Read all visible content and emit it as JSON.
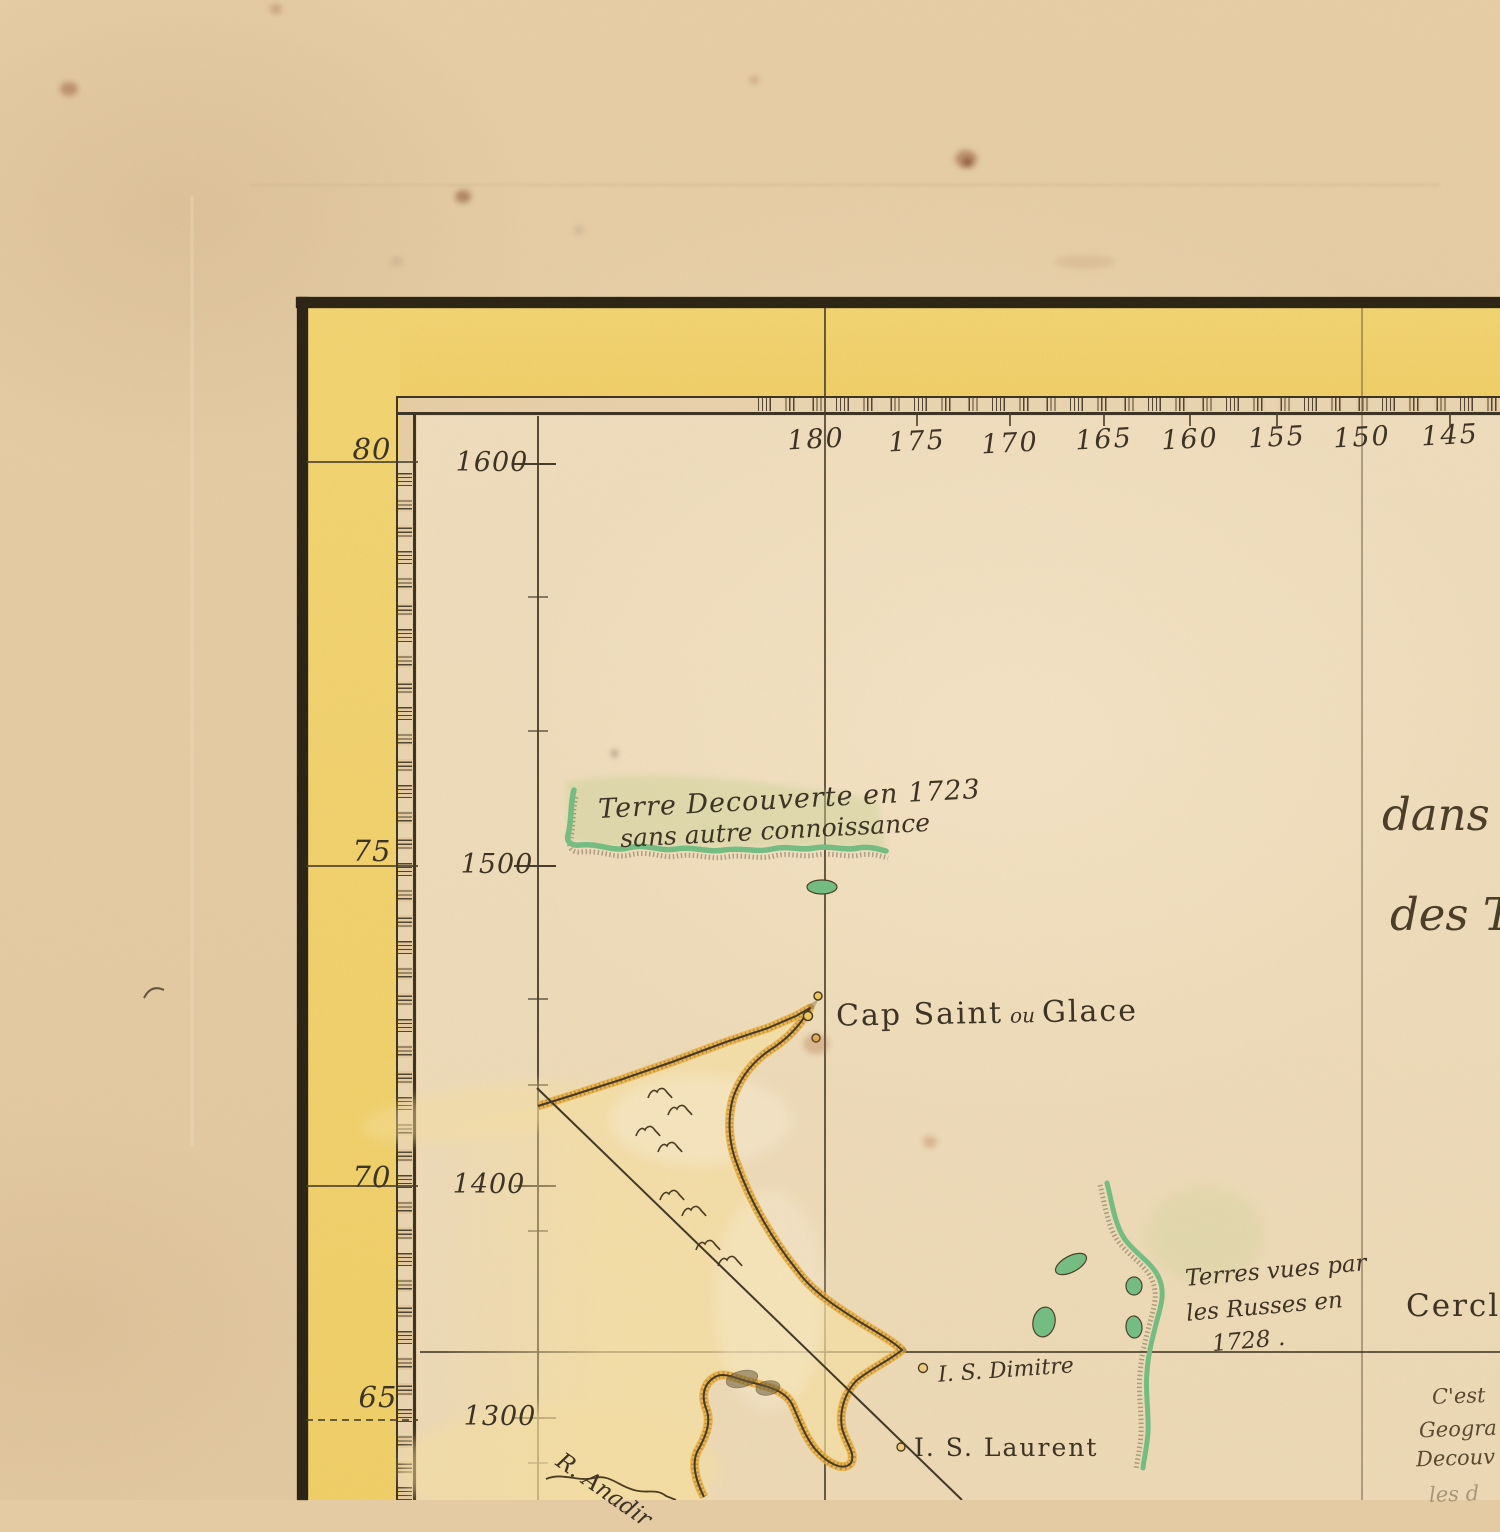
{
  "frame": {
    "longitude_labels": [
      "180",
      "175",
      "170",
      "165",
      "160",
      "155",
      "150",
      "145"
    ],
    "latitude_labels": [
      "80",
      "75",
      "70",
      "65"
    ],
    "scale_labels": [
      "1600",
      "1500",
      "1400",
      "1300"
    ]
  },
  "features": {
    "discovery_1723_line1": "Terre Decouverte en 1723",
    "discovery_1723_line2": "sans autre connoissance",
    "cape_name_main": "Cap Saint",
    "cape_name_connector": "ou",
    "cape_name_alt": "Glace",
    "russian_sightings_line1": "Terres vues par",
    "russian_sightings_line2": "les Russes en",
    "russian_sightings_line3": "1728 .",
    "island_dimitre": "I. S. Dimitre",
    "island_laurent": "I. S. Laurent",
    "river_anadir": "R. Anadir",
    "arctic_circle_fragment": "Cercle",
    "title_fragment_line1": "dans",
    "title_fragment_line2": "des Te",
    "note_fragment_line1": "C'est",
    "note_fragment_line2": "Geogra",
    "note_fragment_line3": "Decouv",
    "note_fragment_line4": "les d"
  },
  "colors": {
    "paper": "#e4cba4",
    "map_field": "#eedcbc",
    "border_band_yellow": "#f0d06c",
    "land_yellow": "#f0c35a",
    "coast_orange": "#e9ae3f",
    "coast_green": "#74bd82",
    "ink": "#332b1c"
  }
}
